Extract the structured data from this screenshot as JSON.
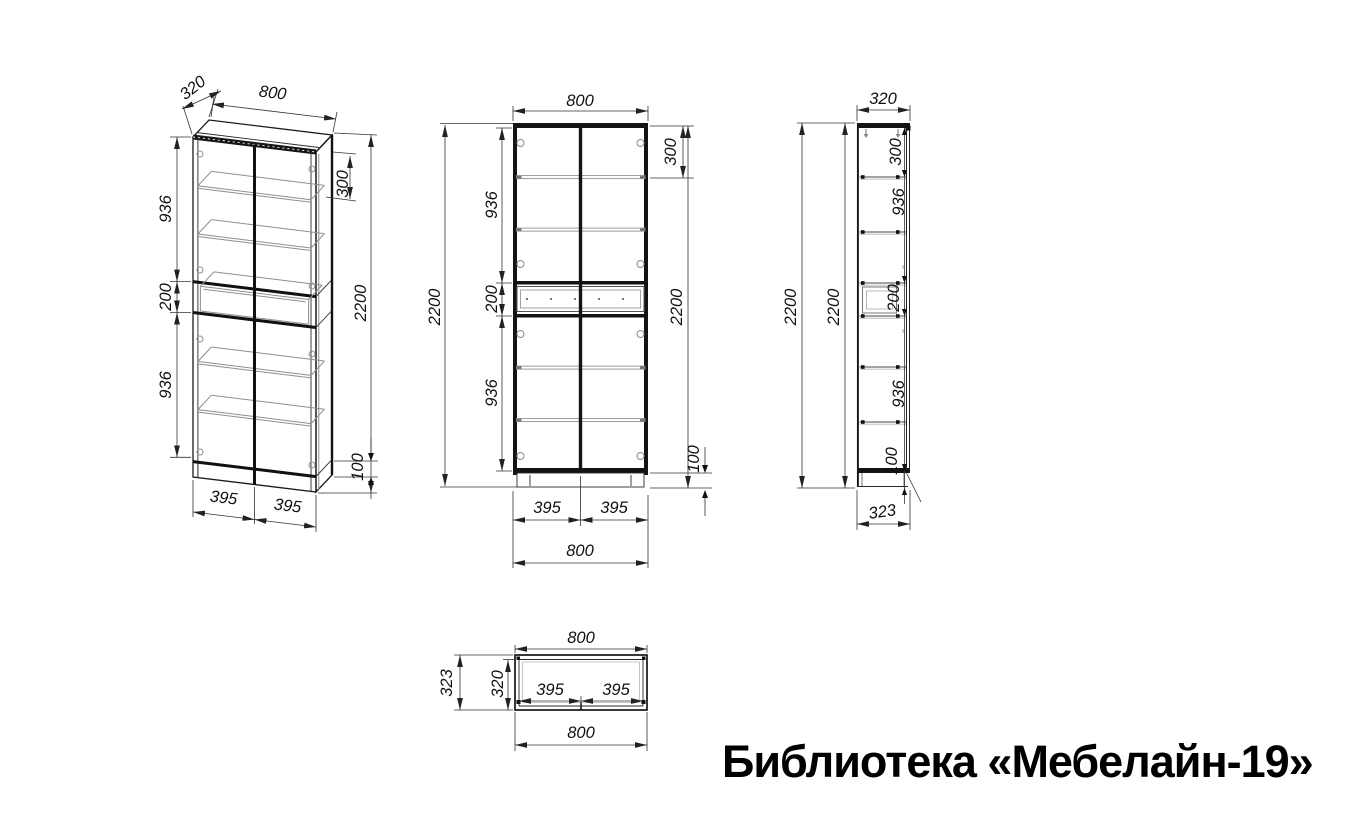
{
  "title": "Библиотека «Мебелайн-19»",
  "views": {
    "isometric": {
      "dims": {
        "depth": "320",
        "width": "800",
        "upper": "936",
        "drawer": "200",
        "lower": "936",
        "top_section": "300",
        "height": "2200",
        "plinth": "100",
        "half_left": "395",
        "half_right": "395"
      }
    },
    "front": {
      "dims": {
        "width_top": "800",
        "top_section": "300",
        "upper": "936",
        "drawer": "200",
        "lower": "936",
        "height_left": "2200",
        "height_right": "2200",
        "plinth": "100",
        "half_left": "395",
        "half_right": "395",
        "width_bottom": "800"
      }
    },
    "side": {
      "dims": {
        "depth_top": "320",
        "height_outer": "2200",
        "height_inner": "2200",
        "top_section": "300",
        "upper": "936",
        "drawer": "200",
        "lower": "936",
        "plinth": "100",
        "depth_bottom": "323"
      }
    },
    "top": {
      "dims": {
        "width_top": "800",
        "depth_outer": "323",
        "depth_inner": "320",
        "half_left": "395",
        "half_right": "395",
        "width_bottom": "800"
      }
    }
  }
}
